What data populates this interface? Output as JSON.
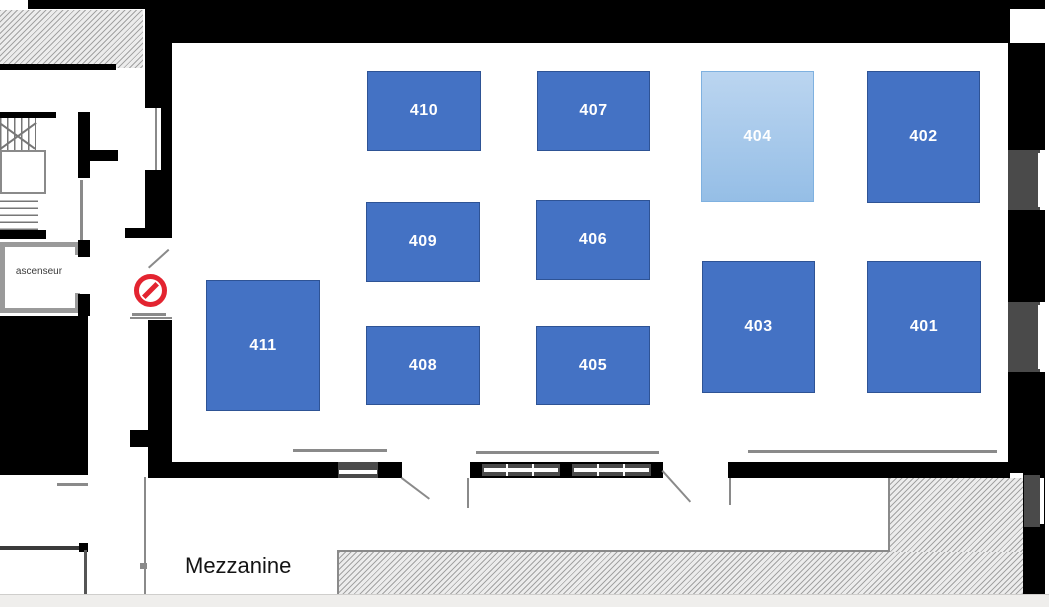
{
  "plan": {
    "title": "Mezzanine floor plan",
    "region_labels": {
      "mezzanine": "Mezzanine",
      "elevator": "ascenseur"
    },
    "rooms": [
      {
        "id": "410",
        "label": "410",
        "x": 367,
        "y": 71,
        "w": 114,
        "h": 80,
        "variant": "standard"
      },
      {
        "id": "407",
        "label": "407",
        "x": 537,
        "y": 71,
        "w": 113,
        "h": 80,
        "variant": "standard"
      },
      {
        "id": "404",
        "label": "404",
        "x": 701,
        "y": 71,
        "w": 113,
        "h": 131,
        "variant": "highlight"
      },
      {
        "id": "402",
        "label": "402",
        "x": 867,
        "y": 71,
        "w": 113,
        "h": 132,
        "variant": "standard"
      },
      {
        "id": "409",
        "label": "409",
        "x": 366,
        "y": 202,
        "w": 114,
        "h": 80,
        "variant": "standard"
      },
      {
        "id": "406",
        "label": "406",
        "x": 536,
        "y": 200,
        "w": 114,
        "h": 80,
        "variant": "standard"
      },
      {
        "id": "411",
        "label": "411",
        "x": 206,
        "y": 280,
        "w": 114,
        "h": 131,
        "variant": "standard"
      },
      {
        "id": "403",
        "label": "403",
        "x": 702,
        "y": 261,
        "w": 113,
        "h": 132,
        "variant": "standard"
      },
      {
        "id": "401",
        "label": "401",
        "x": 867,
        "y": 261,
        "w": 114,
        "h": 132,
        "variant": "standard"
      },
      {
        "id": "408",
        "label": "408",
        "x": 366,
        "y": 326,
        "w": 114,
        "h": 79,
        "variant": "standard"
      },
      {
        "id": "405",
        "label": "405",
        "x": 536,
        "y": 326,
        "w": 114,
        "h": 79,
        "variant": "standard"
      }
    ],
    "symbols": {
      "no_entry": "no-entry-sign"
    },
    "colors": {
      "room_fill": "#4472C4",
      "room_border": "#2E5395",
      "room_text": "#FFFFFF",
      "highlight_top": "#BBD5F0",
      "highlight_bottom": "#95BEE6",
      "highlight_border": "#7FB1E0",
      "wall": "#000000",
      "no_entry_red": "#E32430"
    }
  }
}
